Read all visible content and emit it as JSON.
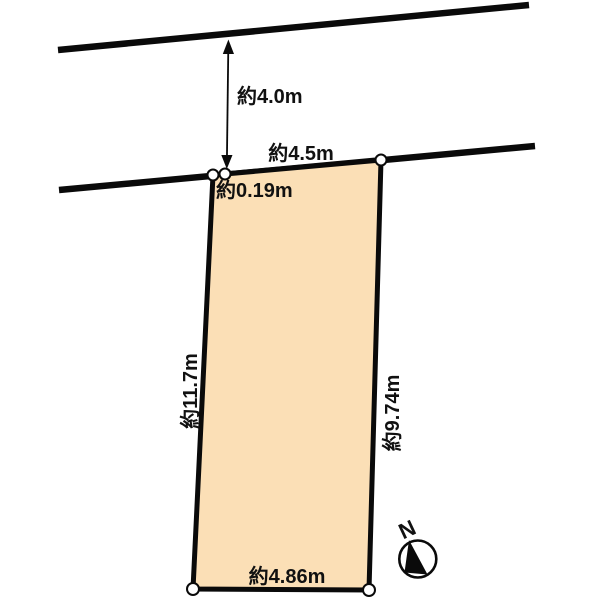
{
  "diagram": {
    "kind": "land-plot-survey-sketch",
    "road": {
      "width_label": "約4.0m",
      "frontage_label": "約4.5m"
    },
    "parcel": {
      "corner_offset_label": "約0.19m",
      "left_side_label": "約11.7m",
      "right_side_label": "約9.74m",
      "bottom_side_label": "約4.86m"
    },
    "compass": {
      "north_label": "N"
    }
  },
  "colors": {
    "parcel_fill": "#fbdfb6",
    "line": "#0a0a0a",
    "background": "#ffffff",
    "marker_fill": "#ffffff"
  }
}
